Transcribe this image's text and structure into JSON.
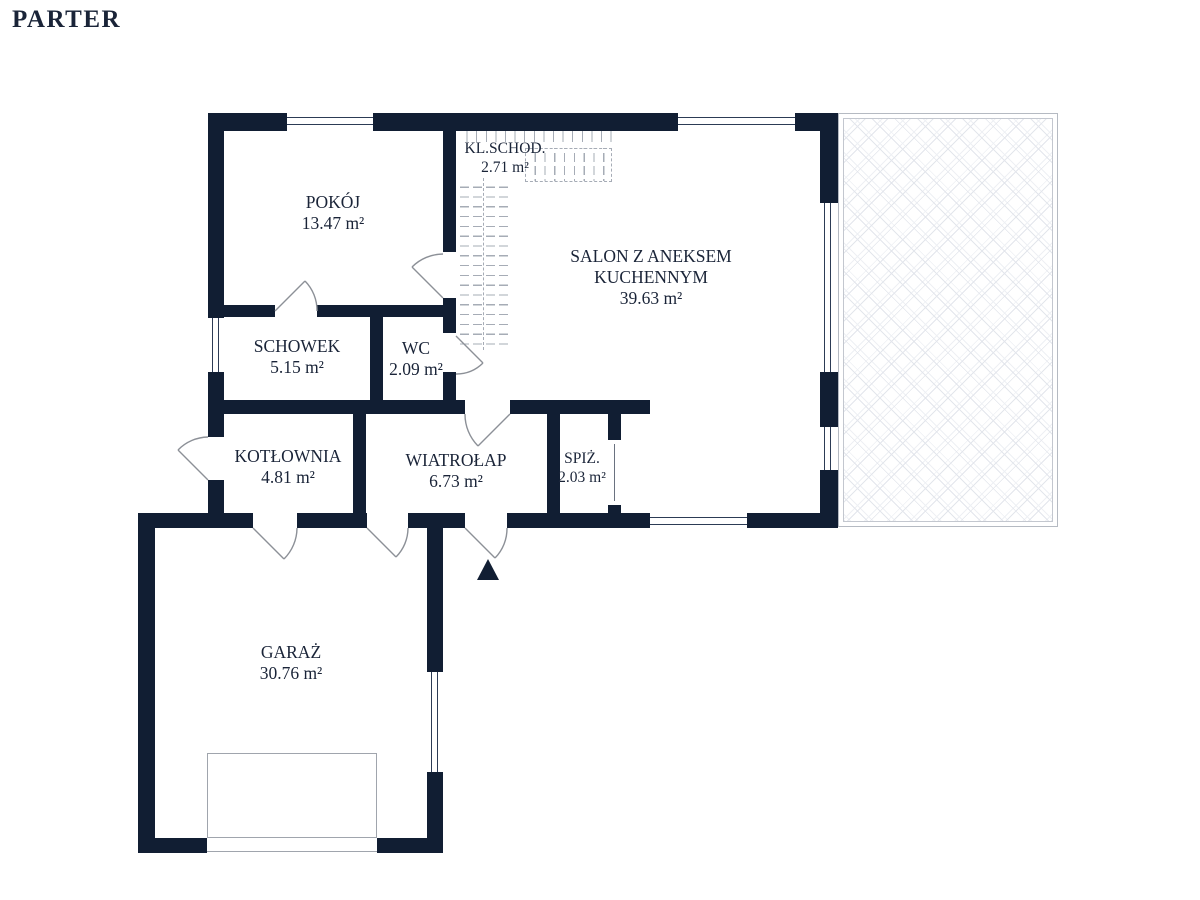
{
  "title": "PARTER",
  "rooms": [
    {
      "label": "POKÓJ",
      "area": "13.47 m²"
    },
    {
      "label": "KL.SCHOD.",
      "area": "2.71 m²"
    },
    {
      "label": "SALON Z ANEKSEM",
      "label2": "KUCHENNYM",
      "area": "39.63 m²"
    },
    {
      "label": "SCHOWEK",
      "area": "5.15 m²"
    },
    {
      "label": "WC",
      "area": "2.09 m²"
    },
    {
      "label": "KOTŁOWNIA",
      "area": "4.81 m²"
    },
    {
      "label": "WIATROŁAP",
      "area": "6.73 m²"
    },
    {
      "label": "SPIŻ.",
      "area": "2.03 m²"
    },
    {
      "label": "GARAŻ",
      "area": "30.76 m²"
    }
  ],
  "colors": {
    "wall": "#111e33",
    "label_text": "#1a2438",
    "door_symbol": "#8c9097",
    "stair_dash": "#a6acb6",
    "terrace_hatch": "#e3e6ec"
  }
}
